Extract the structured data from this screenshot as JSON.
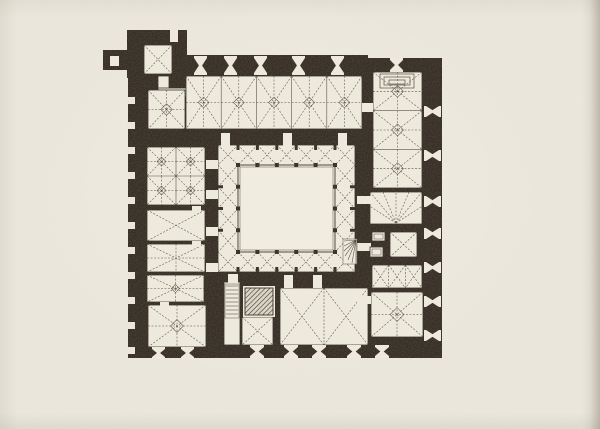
{
  "palette": {
    "paper": "#e9e5da",
    "ink": "#2a2219",
    "room": "#ece8da",
    "court": "#efecdf",
    "line": "#4b4236",
    "hatch_bg": "#d8d3c3"
  },
  "plan": {
    "type": "architectural-floor-plan",
    "canvas": {
      "w": 600,
      "h": 429
    },
    "footprint": [
      [
        127,
        30,
        60,
        48
      ],
      [
        103,
        50,
        26,
        20
      ],
      [
        128,
        55,
        240,
        92
      ],
      [
        362,
        58,
        80,
        132
      ],
      [
        128,
        75,
        92,
        283
      ],
      [
        205,
        127,
        172,
        165
      ],
      [
        352,
        128,
        90,
        230
      ],
      [
        128,
        270,
        314,
        88
      ]
    ],
    "rooms": [
      {
        "name": "nw-tower-chamber",
        "rect": [
          144,
          45,
          28,
          29
        ],
        "vault": "x",
        "bays": [
          1,
          1
        ]
      },
      {
        "name": "entry-passage-a",
        "rect": [
          158,
          76,
          11,
          14
        ],
        "vault": "none"
      },
      {
        "name": "entry-passage-b",
        "rect": [
          158,
          88,
          30,
          9
        ],
        "vault": "none"
      },
      {
        "name": "north-hall-west-bay",
        "rect": [
          148,
          90,
          37,
          39
        ],
        "vault": "star",
        "bays": [
          1,
          1
        ]
      },
      {
        "name": "north-hall",
        "rect": [
          186,
          76,
          176,
          53
        ],
        "vault": "star",
        "bays": [
          5,
          1
        ]
      },
      {
        "name": "northeast-hall",
        "rect": [
          373,
          72,
          49,
          116
        ],
        "vault": "star",
        "bays": [
          1,
          3
        ]
      },
      {
        "name": "east-fan-chamber",
        "rect": [
          370,
          192,
          52,
          32
        ],
        "vault": "fan"
      },
      {
        "name": "east-small-chamber",
        "rect": [
          390,
          232,
          27,
          25
        ],
        "vault": "x",
        "bays": [
          1,
          1
        ]
      },
      {
        "name": "east-triple-chamber",
        "rect": [
          372,
          265,
          50,
          23
        ],
        "vault": "x",
        "bays": [
          3,
          1
        ]
      },
      {
        "name": "southeast-chamber",
        "rect": [
          371,
          292,
          52,
          45
        ],
        "vault": "star",
        "bays": [
          1,
          1
        ]
      },
      {
        "name": "west-upper-hall",
        "rect": [
          147,
          147,
          58,
          58
        ],
        "vault": "star",
        "bays": [
          2,
          2
        ]
      },
      {
        "name": "west-chamber-1",
        "rect": [
          147,
          210,
          58,
          31
        ],
        "vault": "x",
        "bays": [
          1,
          1
        ]
      },
      {
        "name": "west-chamber-2",
        "rect": [
          147,
          244,
          58,
          28
        ],
        "vault": "cross8"
      },
      {
        "name": "west-chamber-3",
        "rect": [
          147,
          275,
          57,
          27
        ],
        "vault": "star",
        "bays": [
          1,
          1
        ]
      },
      {
        "name": "southwest-hall",
        "rect": [
          148,
          305,
          58,
          42
        ],
        "vault": "star",
        "bays": [
          1,
          1
        ]
      },
      {
        "name": "stair-corridor",
        "rect": [
          224,
          282,
          16,
          63
        ],
        "vault": "none"
      },
      {
        "name": "south-small-chamber",
        "rect": [
          242,
          317,
          31,
          28
        ],
        "vault": "x",
        "bays": [
          1,
          1
        ]
      },
      {
        "name": "south-hall",
        "rect": [
          280,
          288,
          88,
          57
        ],
        "vault": "x",
        "bays": [
          2,
          1
        ]
      }
    ],
    "cloister": {
      "outer": [
        218,
        145,
        137,
        127
      ],
      "inner": [
        238,
        165,
        97,
        87
      ],
      "bays_top": 5,
      "bays_side": 4,
      "pillar": 4
    },
    "doors": [
      [
        170,
        30,
        8,
        12
      ],
      [
        110,
        56,
        9,
        10
      ],
      [
        362,
        103,
        11,
        9
      ],
      [
        221,
        133,
        9,
        13
      ],
      [
        283,
        133,
        9,
        13
      ],
      [
        338,
        133,
        9,
        13
      ],
      [
        206,
        160,
        12,
        9
      ],
      [
        206,
        190,
        12,
        9
      ],
      [
        206,
        227,
        12,
        9
      ],
      [
        206,
        263,
        12,
        9
      ],
      [
        357,
        196,
        14,
        8
      ],
      [
        357,
        243,
        14,
        8
      ],
      [
        357,
        296,
        14,
        8
      ],
      [
        284,
        275,
        9,
        13
      ],
      [
        313,
        275,
        9,
        13
      ],
      [
        228,
        274,
        10,
        9
      ],
      [
        192,
        206,
        9,
        6
      ],
      [
        192,
        241,
        9,
        6
      ],
      [
        160,
        302,
        9,
        5
      ]
    ],
    "windows": [
      {
        "x": 194,
        "y": 56,
        "w": 13,
        "h": 19,
        "o": "v"
      },
      {
        "x": 224,
        "y": 56,
        "w": 13,
        "h": 19,
        "o": "v"
      },
      {
        "x": 254,
        "y": 56,
        "w": 13,
        "h": 19,
        "o": "v"
      },
      {
        "x": 292,
        "y": 56,
        "w": 13,
        "h": 19,
        "o": "v"
      },
      {
        "x": 331,
        "y": 56,
        "w": 13,
        "h": 19,
        "o": "v"
      },
      {
        "x": 390,
        "y": 58,
        "w": 13,
        "h": 14,
        "o": "v"
      },
      {
        "x": 152,
        "y": 347,
        "w": 13,
        "h": 12,
        "o": "v"
      },
      {
        "x": 181,
        "y": 347,
        "w": 13,
        "h": 12,
        "o": "v"
      },
      {
        "x": 250,
        "y": 345,
        "w": 14,
        "h": 13,
        "o": "v"
      },
      {
        "x": 284,
        "y": 345,
        "w": 14,
        "h": 13,
        "o": "v"
      },
      {
        "x": 312,
        "y": 345,
        "w": 14,
        "h": 13,
        "o": "v"
      },
      {
        "x": 347,
        "y": 345,
        "w": 14,
        "h": 13,
        "o": "v"
      },
      {
        "x": 375,
        "y": 345,
        "w": 14,
        "h": 13,
        "o": "v"
      },
      {
        "x": 424,
        "y": 106,
        "w": 17,
        "h": 11,
        "o": "h"
      },
      {
        "x": 424,
        "y": 150,
        "w": 17,
        "h": 11,
        "o": "h"
      },
      {
        "x": 424,
        "y": 196,
        "w": 17,
        "h": 11,
        "o": "h"
      },
      {
        "x": 424,
        "y": 228,
        "w": 17,
        "h": 11,
        "o": "h"
      },
      {
        "x": 424,
        "y": 262,
        "w": 17,
        "h": 11,
        "o": "h"
      },
      {
        "x": 424,
        "y": 296,
        "w": 17,
        "h": 11,
        "o": "h"
      },
      {
        "x": 424,
        "y": 330,
        "w": 17,
        "h": 11,
        "o": "h"
      }
    ],
    "left_wall": {
      "cx": 137,
      "r": 6,
      "ys": [
        88,
        113,
        138,
        163,
        188,
        213,
        238,
        263,
        288,
        313,
        338
      ],
      "slot": [
        127,
        8,
        7
      ]
    },
    "details": {
      "stair": {
        "rect": [
          225,
          284,
          14,
          34
        ],
        "step": 4
      },
      "spiral": {
        "rect": [
          343,
          239,
          14,
          25
        ],
        "pivot": [
          356,
          240
        ],
        "targets": [
          [
            344,
            241
          ],
          [
            344,
            246
          ],
          [
            344,
            251
          ],
          [
            345,
            256
          ],
          [
            348,
            260
          ],
          [
            352,
            263
          ],
          [
            356,
            264
          ]
        ]
      },
      "hatch": {
        "pad": [
          243,
          286,
          32,
          31
        ],
        "rect": [
          245,
          288,
          28,
          27
        ]
      },
      "niche": [
        [
          380,
          74,
          34,
          14
        ],
        [
          384,
          77,
          26,
          8
        ],
        [
          389,
          80,
          16,
          4
        ]
      ],
      "ovens": [
        [
          372,
          232,
          13,
          9
        ],
        [
          370,
          247,
          13,
          10
        ]
      ]
    }
  }
}
